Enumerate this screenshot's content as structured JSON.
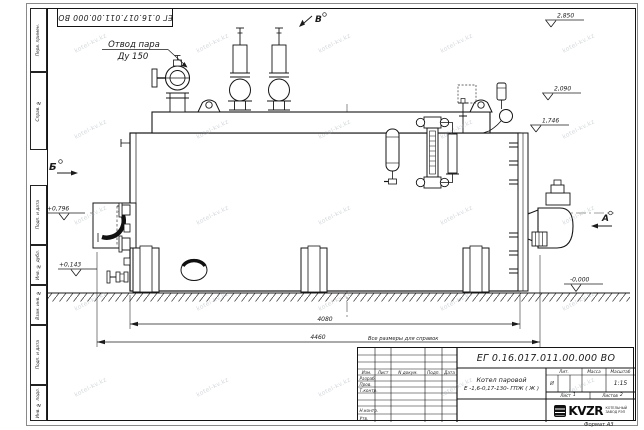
{
  "watermark": {
    "text": "kotel-kv.kz"
  },
  "sheet": {
    "doc_number_stamp": "ЕГ 0.16.017.011.00.000  ВО",
    "reference_note": "Все размеры для справок",
    "format_note": "Формат А3"
  },
  "side_column": {
    "boxes": [
      "Перв. примен.",
      "Справ. №",
      "Подп. и дата",
      "Инв. № дубл.",
      "Взам. инв. №",
      "Подп. и дата",
      "Инв. № подл."
    ]
  },
  "annotations": {
    "steam_outlet_line1": "Отвод пара",
    "steam_outlet_line2": "Ду 150",
    "view_left": "Б",
    "view_top": "В",
    "view_right": "А",
    "elev_top": "2,850",
    "elev_mid": "2,090",
    "elev_low": "1,746",
    "elev_left_upper": "+0,796",
    "elev_left_lower": "+0,143",
    "elev_ground": "-0,000",
    "dim_body": "4080",
    "dim_overall": "4460"
  },
  "title_block": {
    "doc_number": "ЕГ 0.16.017.011.00.000  ВО",
    "product_line1": "Котел паровой",
    "product_line2": "Е -1,6-0,17-130- ГПЖ ( Ж )",
    "col_izm": "Изм.",
    "col_list": "Лист",
    "col_ndoc": "N докум.",
    "col_podp": "Подп.",
    "col_data": "Дата",
    "row_razrab": "Разраб.",
    "row_prov": "Пров.",
    "row_tkontr": "Т.контр.",
    "row_nkontr": "Н.контр.",
    "row_utv": "Утв.",
    "lit_label": "Лит.",
    "lit_value": "И",
    "mass_label": "Масса",
    "scale_label": "Масштаб",
    "scale_value": "1:15",
    "sheet_label": "Лист",
    "sheet_value": "1",
    "sheets_label": "Листов",
    "sheets_value": "2",
    "company_logo": "KVZR",
    "company_line1": "КОТЕЛЬНЫЙ",
    "company_line2": "ЗАВОД РЭП"
  }
}
